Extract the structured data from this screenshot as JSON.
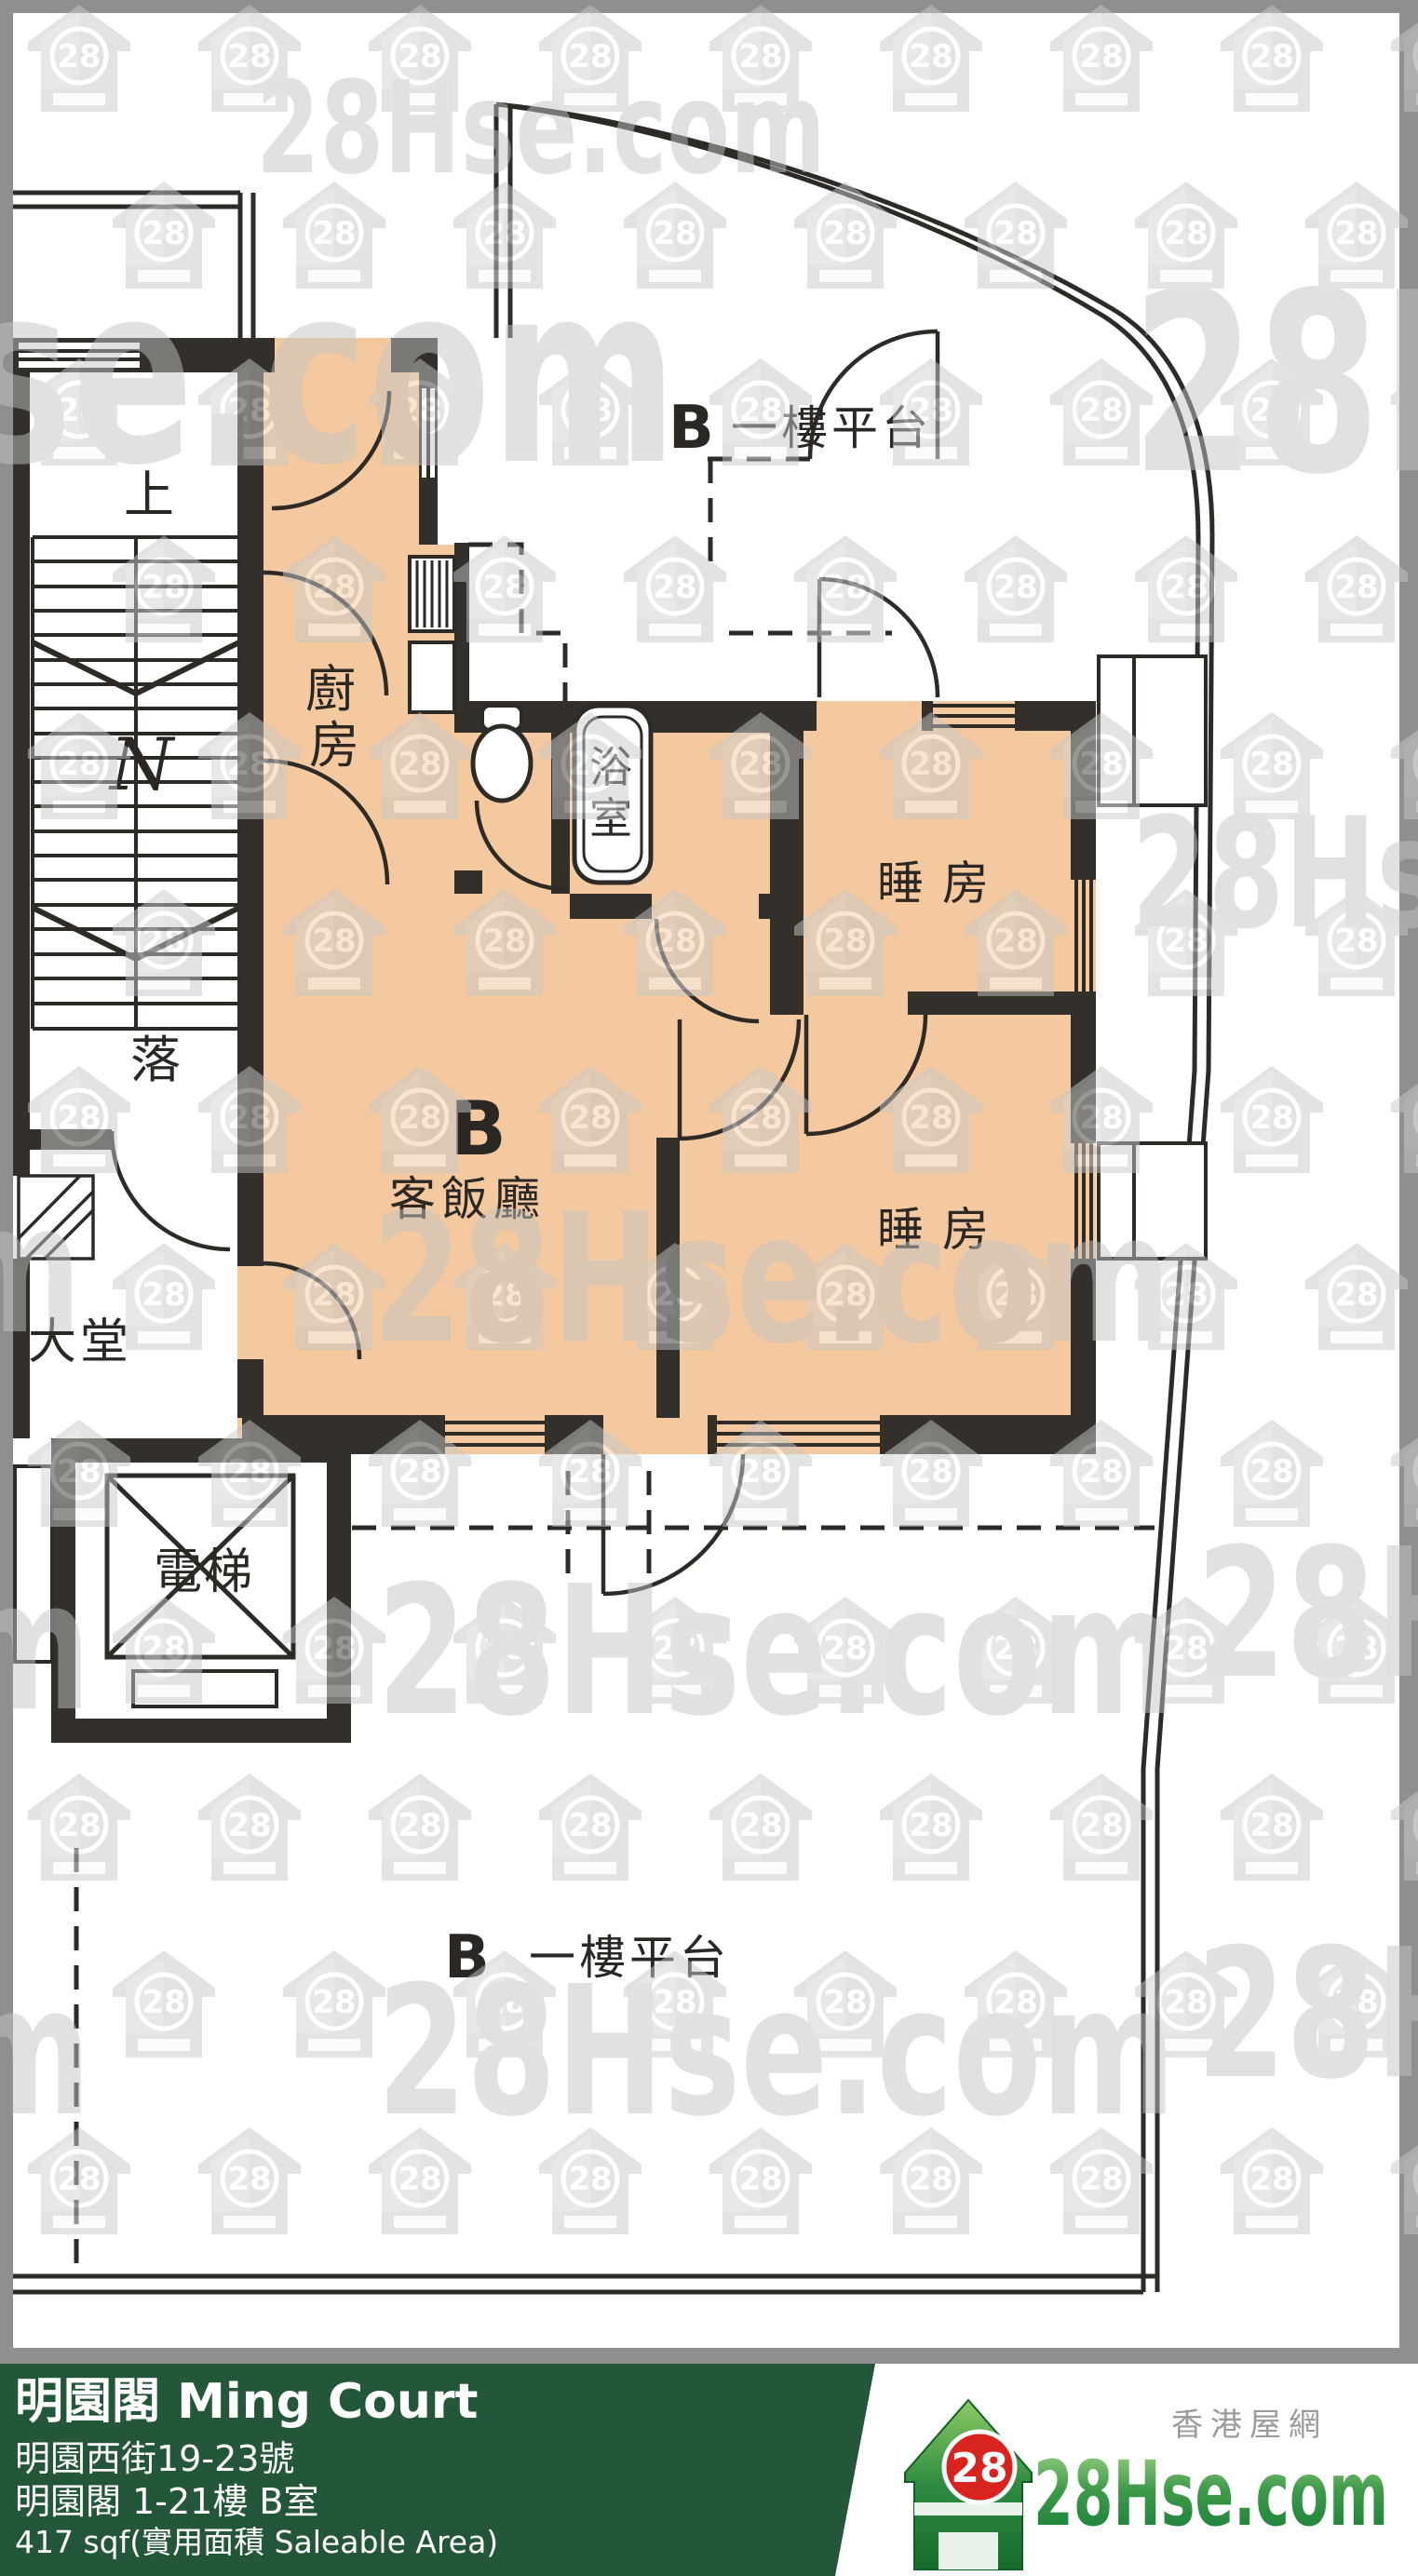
{
  "watermark": {
    "big_text": "28Hse.com",
    "icon_text": "28"
  },
  "plan": {
    "labels": {
      "up": "上",
      "down": "落",
      "north": "N",
      "lobby": "大堂",
      "lift": "電梯",
      "kitchen_1": "廚",
      "kitchen_2": "房",
      "bath_1": "浴",
      "bath_2": "室",
      "bedroom": "睡房",
      "living_unit": "B",
      "living": "客飯廳",
      "platform_unit": "B",
      "platform": "一樓平台"
    }
  },
  "footer": {
    "title": "明園閣 Ming Court",
    "address": "明園西街19-23號",
    "unit": "明園閣 1-21樓 B室",
    "area": "417 sqf(實用面積 Saleable Area)"
  },
  "logo": {
    "badge": "28",
    "site": "28Hse.com",
    "tagline": "香港屋網"
  },
  "colors": {
    "flat_fill": "#f4c9a0",
    "wall": "#33302b",
    "footer_green": "#24573a",
    "watermark_gray": "#c2c2c2",
    "logo_red": "#d8231f",
    "logo_green": "#2e8b40"
  }
}
